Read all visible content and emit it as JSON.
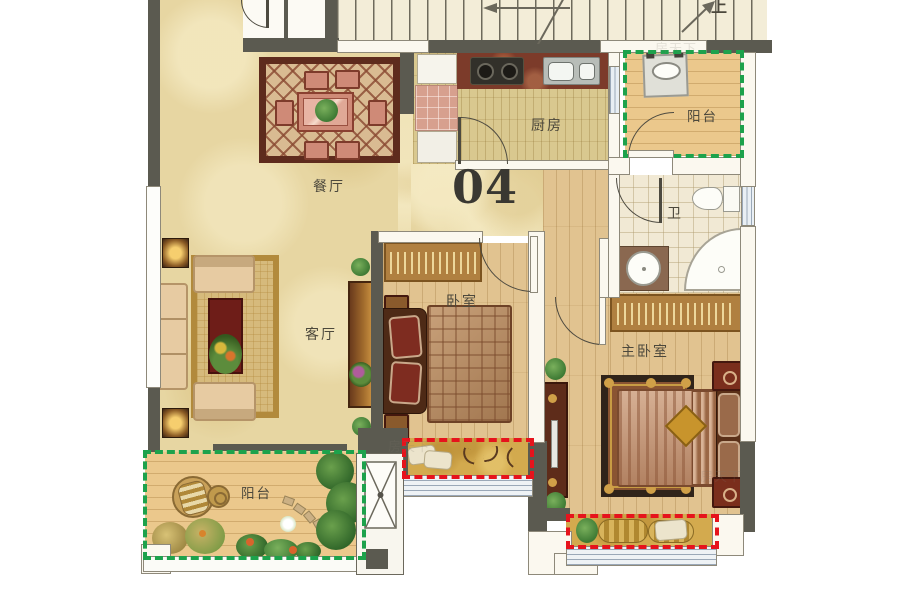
{
  "plan": {
    "unit_number": "04",
    "stairs_direction": "上",
    "watermark": "房天下",
    "rooms": {
      "dining": {
        "label": "餐厅"
      },
      "kitchen": {
        "label": "厨房"
      },
      "balcony_top": {
        "label": "阳台"
      },
      "bathroom": {
        "label": "卫"
      },
      "living": {
        "label": "客厅"
      },
      "bedroom": {
        "label": "卧室"
      },
      "master_bedroom": {
        "label": "主卧室"
      },
      "balcony_bottom": {
        "label": "阳台"
      }
    },
    "legend_colors": {
      "balcony_dashed_outline": "#1da24c",
      "bay_window_dashed_outline": "#e6131c",
      "wall": "#5b5a50"
    }
  }
}
